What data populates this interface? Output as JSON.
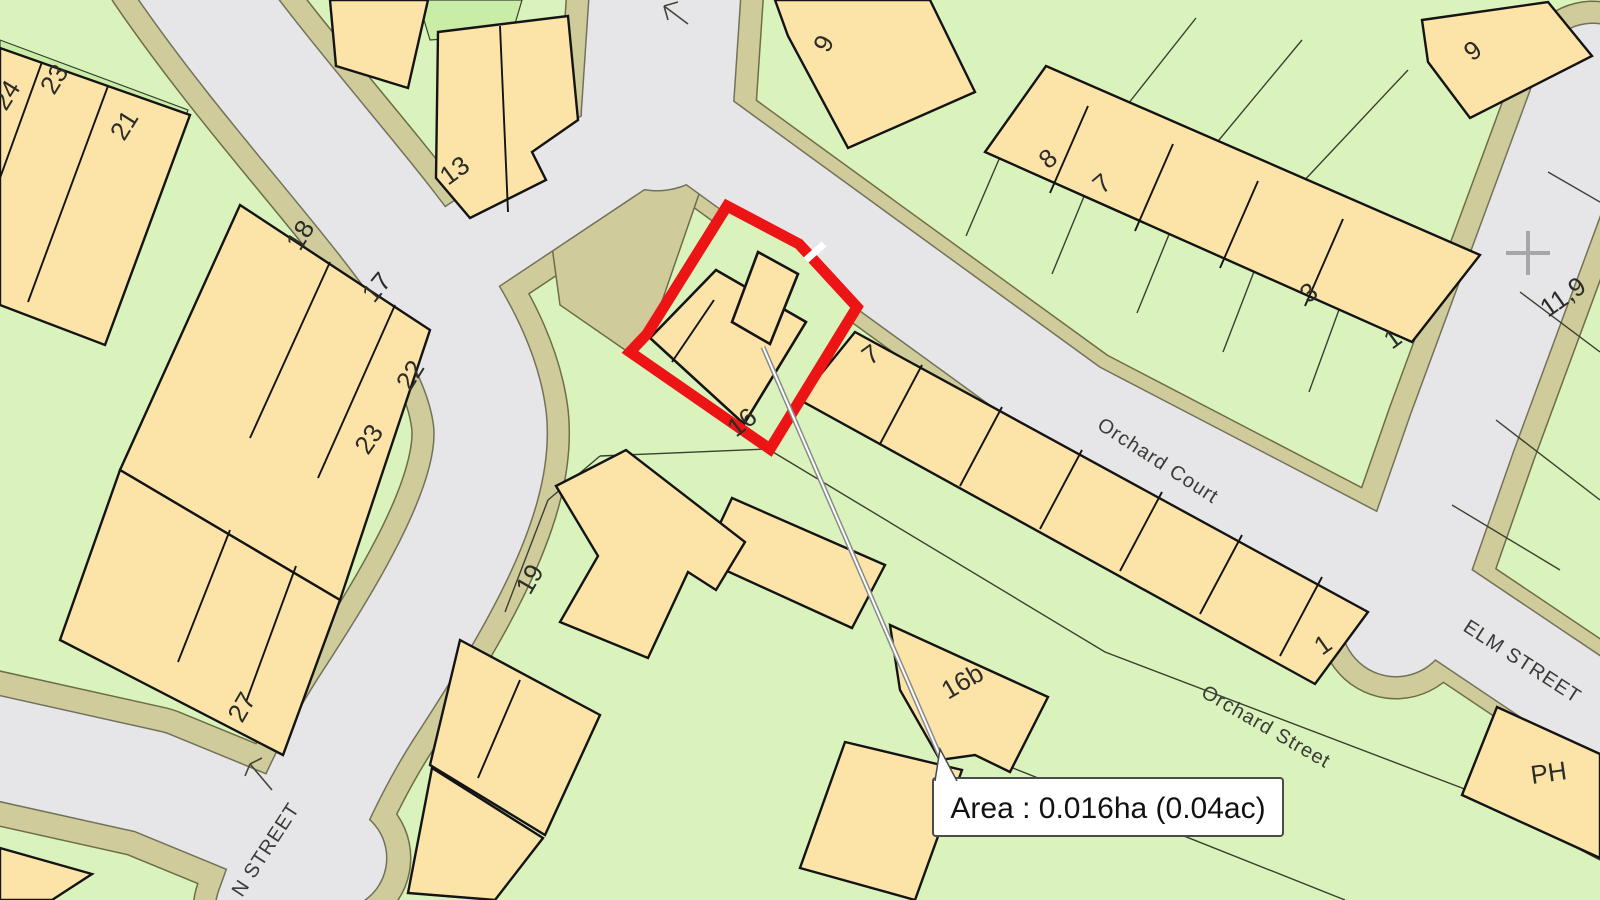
{
  "map": {
    "area_label": {
      "text": "Area : 0.016ha (0.04ac)"
    },
    "streets": {
      "orchard_court": "Orchard Court",
      "elm_street": "ELM STREET",
      "orchard_street": "Orchard Street",
      "n_street": "N STREET"
    },
    "numbers": {
      "n24": "24",
      "n23a": "23",
      "n21": "21",
      "n13": "13",
      "n18": "18",
      "n17": "17",
      "n22": "22",
      "n23b": "23",
      "n19": "19",
      "n27": "27",
      "n9a": "9",
      "n8": "8",
      "n7a": "7",
      "n3": "3",
      "n1a": "1",
      "n9b": "9",
      "n119": "11,9",
      "n7b": "7",
      "n16": "16",
      "n16b": "16b",
      "n1b": "1",
      "nph": "PH"
    },
    "plot": {
      "number": "16",
      "area_ha": "0.016ha",
      "area_ac": "0.04ac"
    },
    "colors": {
      "plot_outline": "#ec1414",
      "road": "#e6e6e9",
      "verge": "#cfcb9b",
      "building": "#fce4a8",
      "land": "#daf3bc",
      "land_alt": "#c9eda6"
    }
  }
}
